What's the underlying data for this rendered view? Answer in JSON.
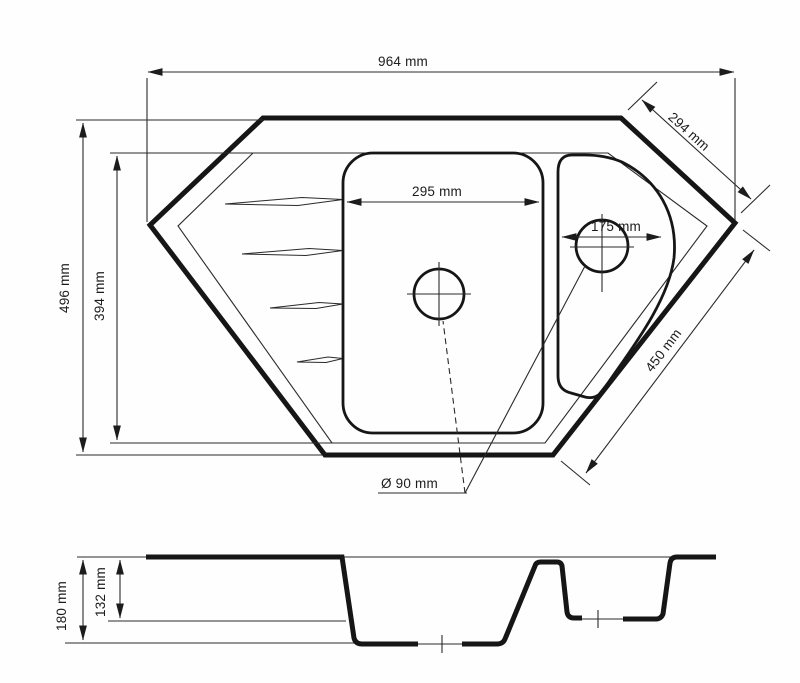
{
  "drawing": {
    "type": "technical-drawing",
    "subject": "corner kitchen sink with one and a half bowls and drainer grooves",
    "views": {
      "top_view": {
        "labels": {
          "overall_width": "964 mm",
          "top_right_edge": "294 mm",
          "overall_depth": "496 mm",
          "inner_depth": "394 mm",
          "main_bowl_width": "295 mm",
          "small_bowl_width": "175 mm",
          "bottom_right_edge": "450 mm",
          "drain_diameter": "Ø 90 mm"
        }
      },
      "section_view": {
        "labels": {
          "total_depth": "180 mm",
          "small_bowl_depth": "132 mm"
        }
      }
    },
    "colors": {
      "line": "#161616",
      "background": "#fefefe"
    }
  }
}
